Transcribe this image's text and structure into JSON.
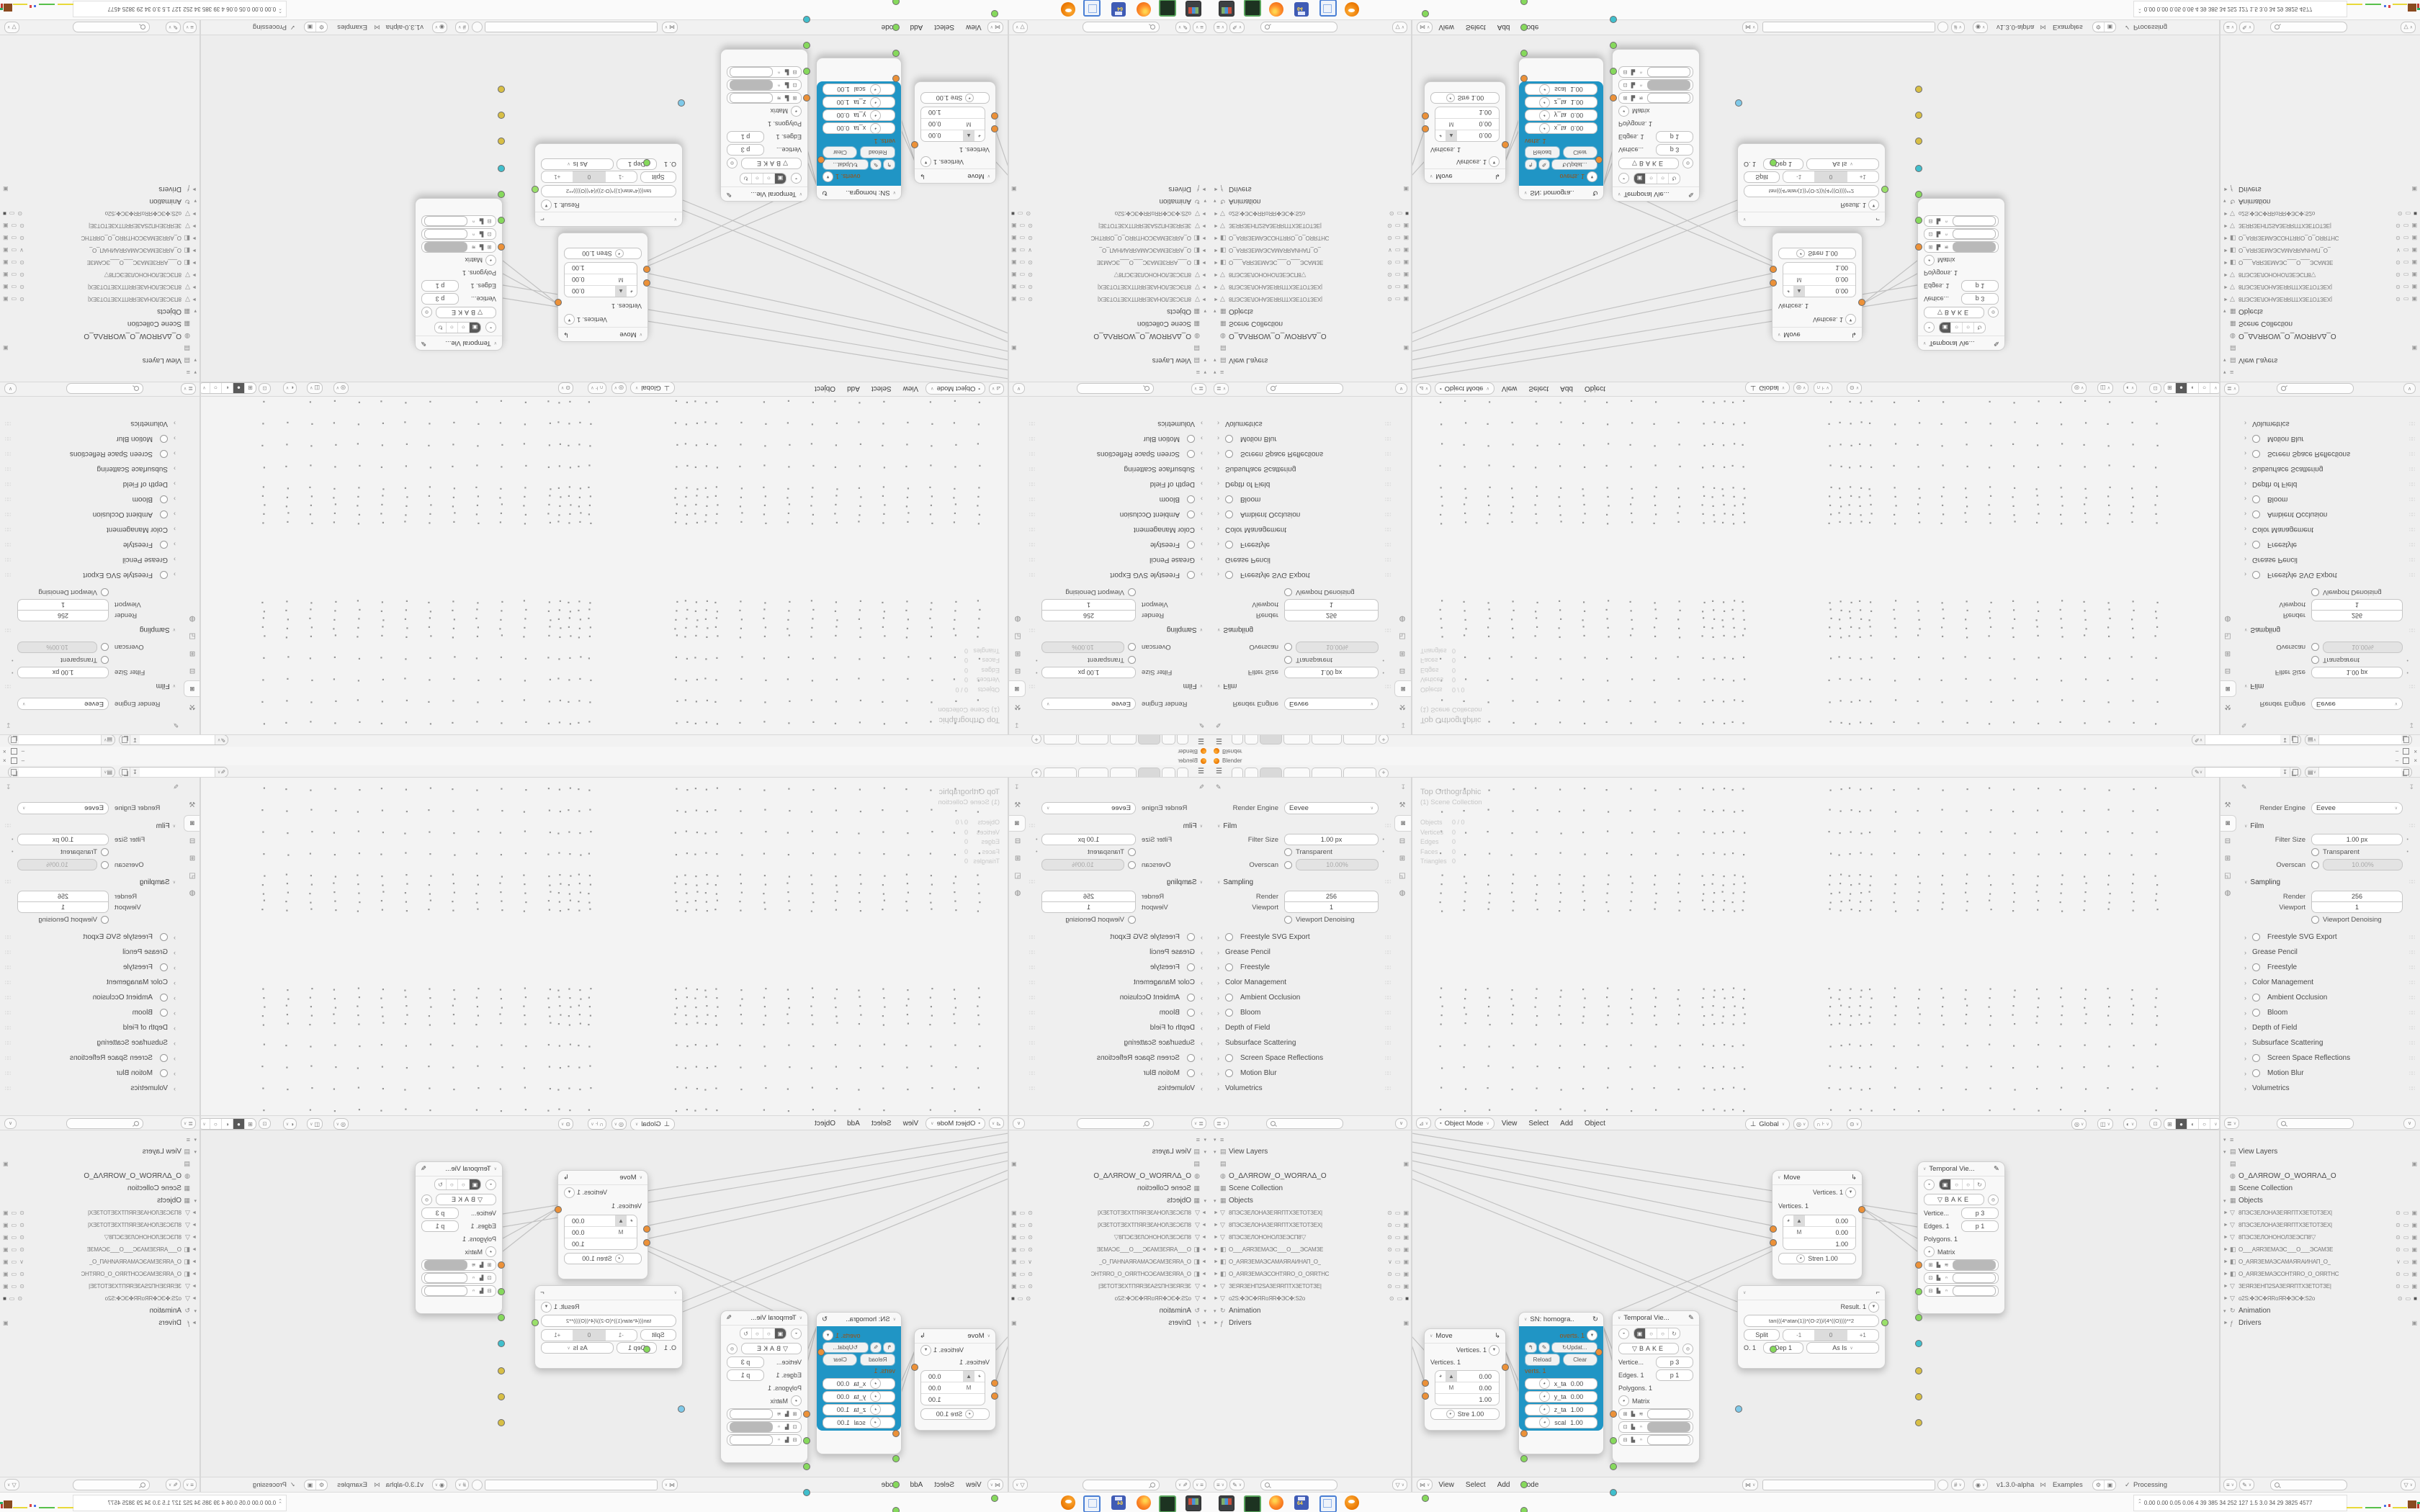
{
  "window": {
    "title": "Blender",
    "min": "–",
    "close": "×"
  },
  "topbar": {
    "add_tab": "+",
    "tab_count": 6,
    "active_tab": 2
  },
  "properties": {
    "render_engine_label": "Render Engine",
    "render_engine_value": "Eevee",
    "film": {
      "label": "Film",
      "filter_size_label": "Filter Size",
      "filter_size_value": "1.00 px",
      "transparent_label": "Transparent",
      "overscan_label": "Overscan",
      "overscan_value": "10.00%"
    },
    "sampling": {
      "label": "Sampling",
      "render_label": "Render",
      "render_value": "256",
      "viewport_label": "Viewport",
      "viewport_value": "1",
      "denoise_label": "Viewport Denoising"
    },
    "sections": [
      {
        "label": "Freestyle SVG Export",
        "check": true
      },
      {
        "label": "Grease Pencil",
        "check": false
      },
      {
        "label": "Freestyle",
        "check": true
      },
      {
        "label": "Color Management",
        "check": false
      },
      {
        "label": "Ambient Occlusion",
        "check": true
      },
      {
        "label": "Bloom",
        "check": true
      },
      {
        "label": "Depth of Field",
        "check": false
      },
      {
        "label": "Subsurface Scattering",
        "check": false
      },
      {
        "label": "Screen Space Reflections",
        "check": true
      },
      {
        "label": "Motion Blur",
        "check": true
      },
      {
        "label": "Volumetrics",
        "check": false
      }
    ]
  },
  "viewport": {
    "view_label": "Top Orthographic",
    "collection_label": "(1) Scene Collection",
    "stats": [
      [
        "Objects",
        "0 / 0"
      ],
      [
        "Vertices",
        "0"
      ],
      [
        "Edges",
        "0"
      ],
      [
        "Faces",
        "0"
      ],
      [
        "Triangles",
        "0"
      ]
    ],
    "mode": "Object Mode",
    "menus": [
      "View",
      "Select",
      "Add",
      "Object"
    ],
    "orientation": "Global"
  },
  "outliner": {
    "rows": [
      {
        "k": "scene-filter",
        "arrow": "▾",
        "icon": "≡",
        "label": "",
        "big": true
      },
      {
        "k": "view-layers",
        "arrow": "▾",
        "icon": "▤",
        "label": "View Layers",
        "big": true
      },
      {
        "k": "view-layer-item",
        "arrow": "",
        "icon": "▤",
        "label": "",
        "big": true,
        "r": [
          "cam"
        ]
      },
      {
        "k": "world",
        "arrow": "",
        "icon": "◍",
        "label": "O_ΔΛЯROW_O_WOЯRΛΔ_O",
        "big": true
      },
      {
        "k": "scene-collection",
        "arrow": "",
        "icon": "▦",
        "label": "Scene Collection",
        "big": true
      },
      {
        "k": "objects",
        "arrow": "▾",
        "icon": "▦",
        "label": "Objects",
        "big": true
      },
      {
        "k": "object",
        "arrow": "►",
        "icon": "▽",
        "label": "8ПЭСЗЕЛОНАЗЕЯRПТХЗЕТОТЗЕХ|",
        "r": [
          "eye",
          "scr",
          "cam"
        ]
      },
      {
        "k": "object",
        "arrow": "►",
        "icon": "▽",
        "label": "8ПЭСЗЕЛОНАЗЕЯRПТХЗЕТОТЗЕХ|",
        "r": [
          "eye",
          "scr",
          "cam"
        ]
      },
      {
        "k": "object",
        "arrow": "►",
        "icon": "▽",
        "label": "8ПЭСЗЕЛОНОНОЛЗЕЭСП8",
        "extra": "▽",
        "r": [
          "eye",
          "scr",
          "cam"
        ]
      },
      {
        "k": "object",
        "arrow": "►",
        "icon": "◧",
        "label": "O___АЯRЗЕМАЭС___O___ЭСАМЗЕ",
        "r": [
          "eye",
          "scr",
          "cam"
        ]
      },
      {
        "k": "object",
        "arrow": "►",
        "icon": "◧",
        "label": "O_АЯRЗЕМАЭСАМАЯRАИНАП_O_",
        "r": [
          "chev",
          "scr",
          "cam"
        ]
      },
      {
        "k": "object",
        "arrow": "►",
        "icon": "◧",
        "label": "O_АЯRЗЕМАЭСОНТЯRО_O_ОЯRТНС",
        "r": [
          "eye",
          "scr",
          "cam"
        ]
      },
      {
        "k": "object",
        "arrow": "►",
        "icon": "▽",
        "label": "ЗЕЯRЗЕНП2SАЗЕЯRПТХЗЕТОТЗЕ|",
        "r": [
          "eye",
          "scr",
          "cam"
        ]
      },
      {
        "k": "object",
        "arrow": "►",
        "icon": "▽",
        "label": "о2Ѕ:✤ЭС✤ЯRоЯR✤ЭС✤:Ѕ2о",
        "r": [
          "eye",
          "scr",
          "camf"
        ]
      },
      {
        "k": "animation",
        "arrow": "▾",
        "icon": "↻",
        "label": "Animation",
        "big": true
      },
      {
        "k": "drivers",
        "arrow": "►",
        "icon": "ƒ",
        "label": "Drivers",
        "big": true,
        "r": [
          "box"
        ]
      }
    ]
  },
  "node_editor": {
    "menus": [
      "View",
      "Select",
      "Add",
      "Node"
    ],
    "version": "v1.3.0-alpha",
    "examples": "Examples",
    "processing": "Processing",
    "move": {
      "title": "Move",
      "out": "Vertices. 1",
      "inp": "Vertices. 1",
      "m_label": "M",
      "mat": [
        "0.00",
        "0.00",
        "1.00"
      ],
      "stren_short": "Stre  1.00",
      "stren_long": "Stren  1.00"
    },
    "sn": {
      "title": "SN: homogra..",
      "out": "overts. 1",
      "update": "Updat...",
      "reload": "Reload",
      "clear": "Clear",
      "inp": "verts. 1",
      "fields": [
        [
          "x_ta",
          "0.00"
        ],
        [
          "y_ta",
          "0.00"
        ],
        [
          "z_ta",
          "1.00"
        ],
        [
          "scal",
          "1.00"
        ]
      ]
    },
    "temporal": {
      "title": "Temporal Vie...",
      "bake": "BAKE",
      "vertices_label": "Vertice...",
      "vertices_value": "p  3",
      "edges_label": "Edges. 1",
      "edges_value": "p  1",
      "polygons_label": "Polygons. 1",
      "matrix_label": "Matrix"
    },
    "formula": {
      "result": "Result. 1",
      "formula": "tan(((4*atan(1))*(O-2))/(4*((O))))**2",
      "split": "Split",
      "minus": "-1",
      "zero": "0",
      "plus": "+1",
      "o_label": "O. 1",
      "dep": "Dep 1",
      "asis": "As Is"
    }
  },
  "taskbar": {
    "stats": "0.00 0.00 0.05 0.06   4    39   385   34   252   127   1.5   3.0   34    29   3825 4577"
  }
}
